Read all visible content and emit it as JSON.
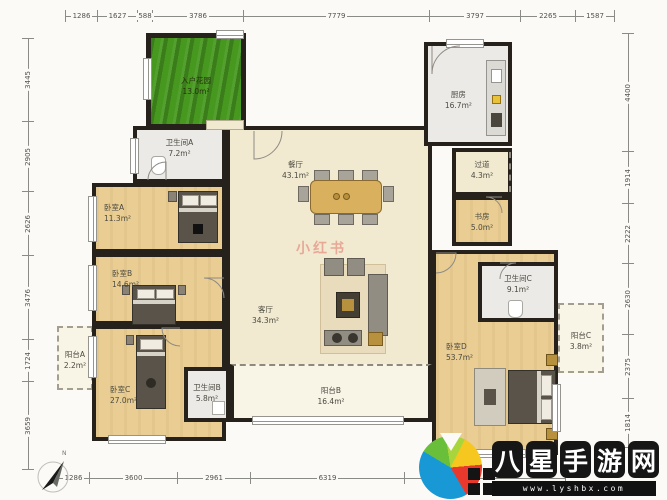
{
  "rooms": {
    "garden": {
      "name": "入户花园",
      "area": "13.0m²"
    },
    "bathA": {
      "name": "卫生间A",
      "area": "7.2m²"
    },
    "bedA": {
      "name": "卧室A",
      "area": "11.3m²"
    },
    "dining": {
      "name": "餐厅",
      "area": "43.1m²"
    },
    "kitchen": {
      "name": "厨房",
      "area": "16.7m²"
    },
    "hallway": {
      "name": "过道",
      "area": "4.3m²"
    },
    "study": {
      "name": "书房",
      "area": "5.0m²"
    },
    "bedB": {
      "name": "卧室B",
      "area": "14.6m²"
    },
    "living": {
      "name": "客厅",
      "area": "34.3m²"
    },
    "bathC": {
      "name": "卫生间C",
      "area": "9.1m²"
    },
    "balcA": {
      "name": "阳台A",
      "area": "2.2m²"
    },
    "bedC": {
      "name": "卧室C",
      "area": "27.0m²"
    },
    "bathB": {
      "name": "卫生间B",
      "area": "5.8m²"
    },
    "balcB": {
      "name": "阳台B",
      "area": "16.4m²"
    },
    "bedD": {
      "name": "卧室D",
      "area": "53.7m²"
    },
    "balcC": {
      "name": "阳台C",
      "area": "3.8m²"
    }
  },
  "dims": {
    "top": [
      "1286",
      "1627",
      "588",
      "3786",
      "7779",
      "3797",
      "2265",
      "1587"
    ],
    "bottom": [
      "1286",
      "3600",
      "2961",
      "6319"
    ],
    "left": [
      "3445",
      "2905",
      "2626",
      "3476",
      "1724",
      "3659"
    ],
    "right": [
      "4400",
      "1914",
      "2222",
      "2630",
      "2375",
      "1814"
    ]
  },
  "compass": {
    "label": "N"
  },
  "watermarks": {
    "center": "小红书",
    "site_name": "八星手游网",
    "site_url": "www.lyshbx.com"
  },
  "colors": {
    "wall": "#26211b",
    "floor_wood": "#e9cd93",
    "floor_cream": "#f1ead0",
    "floor_gray": "#ebeae6",
    "garden": "#46981f",
    "balcony": "#f8f4e6"
  }
}
